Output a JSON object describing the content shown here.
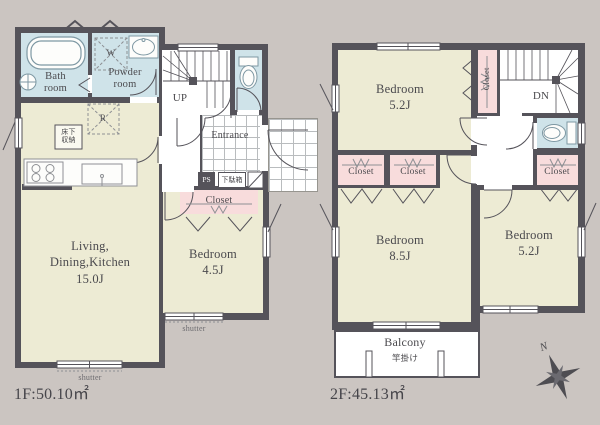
{
  "colors": {
    "background": "#cbc5c1",
    "wall": "#55535a",
    "room_cream": "#edebd4",
    "wet_area_blue": "#cfe3e9",
    "closet_pink": "#f8dcdc",
    "floor_white": "#ffffff",
    "line_gray": "#8e9094",
    "text": "#4b4a4e"
  },
  "floor1": {
    "area_label": "1F:50.10㎡",
    "rooms": {
      "bath": {
        "line1": "Bath",
        "line2": "room"
      },
      "powder": {
        "line1": "Powder",
        "line2": "room"
      },
      "ldk": {
        "line1": "Living,",
        "line2": "Dining,Kitchen",
        "line3": "15.0J"
      },
      "bedroom": {
        "line1": "Bedroom",
        "line2": "4.5J"
      },
      "entrance": "Entrance"
    },
    "labels": {
      "up": "UP",
      "ps": "PS",
      "shoe_cabinet": "下駄箱",
      "closet": "Closet",
      "underfloor_storage": {
        "line1": "床下",
        "line2": "収納"
      },
      "washer": "W",
      "fridge": "R",
      "shutter": "shutter"
    }
  },
  "floor2": {
    "area_label": "2F:45.13㎡",
    "rooms": {
      "bedroom_north": {
        "line1": "Bedroom",
        "line2": "5.2J"
      },
      "bedroom_center": {
        "line1": "Bedroom",
        "line2": "8.5J"
      },
      "bedroom_east": {
        "line1": "Bedroom",
        "line2": "5.2J"
      },
      "balcony": "Balcony"
    },
    "labels": {
      "dn": "DN",
      "closet_north": "Closet",
      "closet_a": "Closet",
      "closet_b": "Closet",
      "closet_east": "Closet",
      "pole_hanger": "竿掛け"
    }
  },
  "compass": {
    "north": "N"
  }
}
